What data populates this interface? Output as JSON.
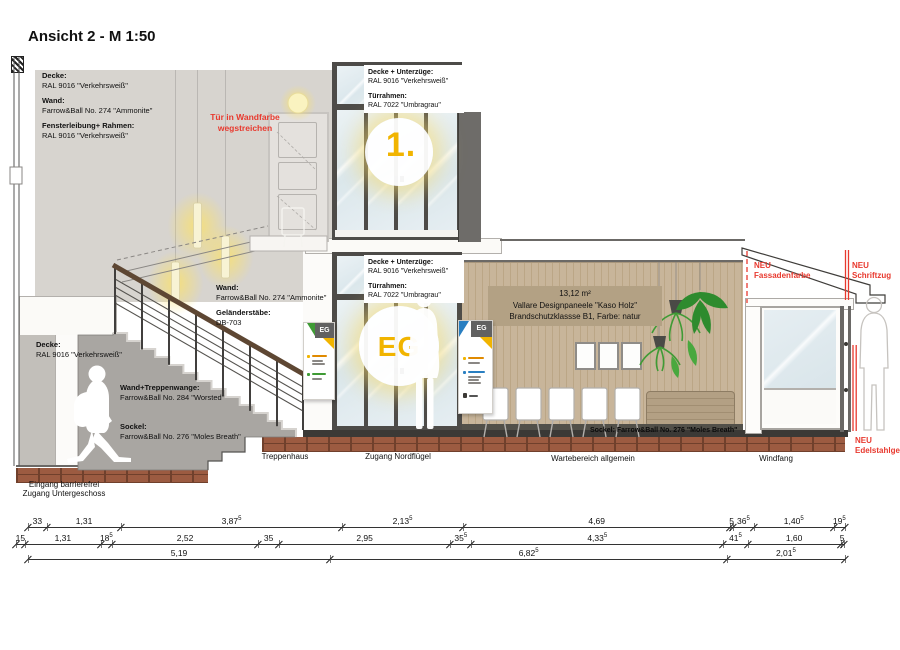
{
  "title": "Ansicht 2 - M 1:50",
  "colors": {
    "red_note": "#e8392e",
    "signal_yellow": "#f1b400",
    "handrail_brown": "#5e4733",
    "wood_wall": "#c8b59a",
    "glass_blue": "#dbe7ec",
    "brick_floor": "#9c5b41",
    "wall_gray": "#d7d4cf"
  },
  "materials": {
    "og": [
      {
        "h": "Decke:",
        "t": "RAL 9016 \"Verkehrsweiß\""
      },
      {
        "h": "Wand:",
        "t": "Farrow&Ball No. 274 \"Ammonite\""
      },
      {
        "h": "Fensterleibung+ Rahmen:",
        "t": "RAL 9016 \"Verkehrsweiß\""
      }
    ],
    "mid": [
      {
        "h": "Wand:",
        "t": "Farrow&Ball No. 274 \"Ammonite\""
      },
      {
        "h": "Geländerstäbe:",
        "t": "DB-703"
      }
    ],
    "ug": [
      {
        "h": "Decke:",
        "t": "RAL 9016 \"Verkehrsweiß\""
      },
      {
        "h": "Wand+Treppenwange:",
        "t": "Farrow&Ball No. 284 \"Worsted\""
      },
      {
        "h": "Sockel:",
        "t": "Farrow&Ball No. 276 \"Moles Breath\""
      }
    ],
    "glass_og": {
      "h1": "Decke + Unterzüge:",
      "t1": "RAL 9016 \"Verkehrsweiß\"",
      "h2": "Türrahmen:",
      "t2": "RAL 7022 \"Umbragrau\""
    },
    "glass_eg": {
      "h1": "Decke + Unterzüge:",
      "t1": "RAL 9016 \"Verkehrsweiß\"",
      "h2": "Türrahmen:",
      "t2": "RAL 7022 \"Umbragrau\""
    },
    "sockel_inline": "Sockel: Farrow&Ball No. 276 \"Moles Breath\"",
    "wood_panel": {
      "l1": "13,12 m²",
      "l2": "Vallare Designpaneele \"Kaso Holz\"",
      "l3": "Brandschutzklassse B1, Farbe: natur"
    }
  },
  "red_notes": {
    "tuer": "Tür in Wandfarbe\nwegstreichen",
    "fassade": "NEU\nFassadenfarbe",
    "schriftzug": "NEU\nSchriftzug",
    "gelaender": "NEU\nEdelstahlgeländer"
  },
  "rooms": {
    "treppenhaus": "Treppenhaus",
    "nordfluegel": "Zugang Nordflügel",
    "wartebereich": "Wartebereich allgemein",
    "windfang": "Windfang",
    "eingang": "Eingang barrierefrei\nZugang Untergeschoss"
  },
  "signs": {
    "floor_big_og": "1.",
    "floor_big_eg": "EG",
    "door_sign": "EG"
  },
  "dimensions": {
    "rows": [
      {
        "y": 527,
        "x0": 28,
        "ppm": 56.9,
        "segs": [
          {
            "v": "33",
            "m": 0.33
          },
          {
            "v": "1,31",
            "m": 1.31
          },
          {
            "v": "3,87",
            "s": "5",
            "m": 3.875
          },
          {
            "v": "2,13",
            "s": "5",
            "m": 2.135
          },
          {
            "v": "4,69",
            "m": 4.69
          },
          {
            "v": "5",
            "m": 0.05
          },
          {
            "v": "36",
            "s": "5",
            "m": 0.365
          },
          {
            "v": "1,40",
            "s": "5",
            "m": 1.405
          },
          {
            "v": "19",
            "s": "5",
            "m": 0.195
          }
        ]
      },
      {
        "y": 544,
        "x0": 16,
        "ppm": 58.2,
        "segs": [
          {
            "v": "15",
            "m": 0.15
          },
          {
            "v": "1,31",
            "m": 1.31
          },
          {
            "v": "18",
            "s": "5",
            "m": 0.185
          },
          {
            "v": "2,52",
            "m": 2.52
          },
          {
            "v": "35",
            "m": 0.35
          },
          {
            "v": "2,95",
            "m": 2.95
          },
          {
            "v": "35",
            "s": "5",
            "m": 0.355
          },
          {
            "v": "4,33",
            "s": "5",
            "m": 4.335
          },
          {
            "v": "41",
            "s": "5",
            "m": 0.415
          },
          {
            "v": "1,60",
            "m": 1.6
          },
          {
            "v": "5",
            "m": 0.05
          }
        ]
      },
      {
        "y": 559,
        "x0": 28,
        "ppm": 58.2,
        "segs": [
          {
            "v": "5,19",
            "m": 5.19
          },
          {
            "v": "6,82",
            "s": "5",
            "m": 6.825
          },
          {
            "v": "2,01",
            "s": "5",
            "m": 2.015
          }
        ]
      }
    ]
  }
}
